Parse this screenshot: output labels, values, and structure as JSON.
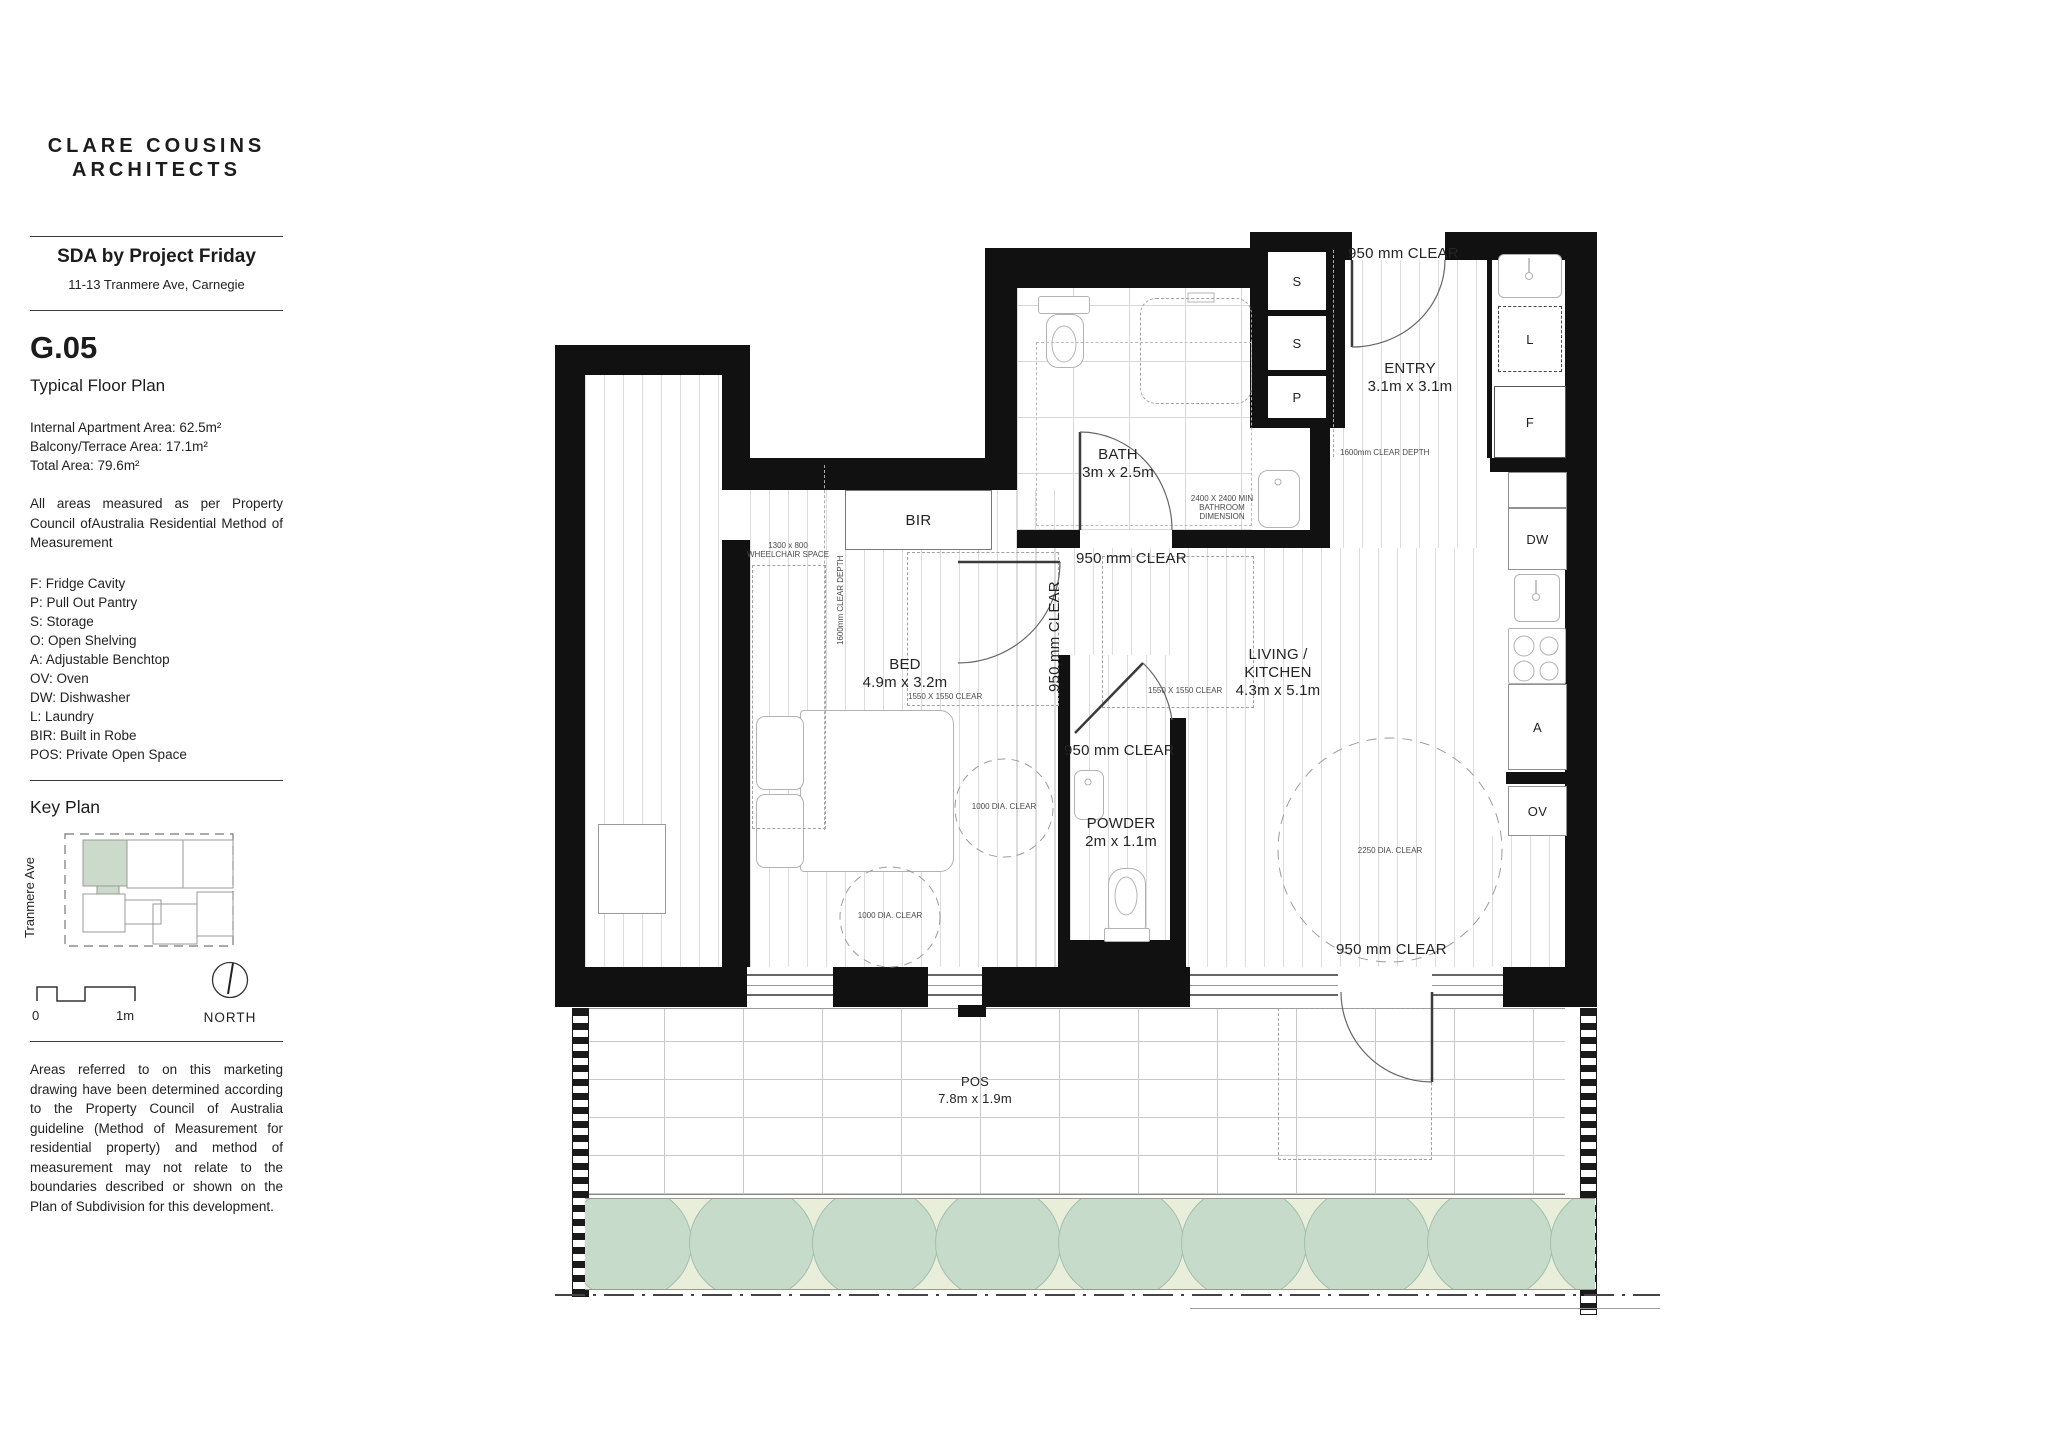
{
  "sidebar": {
    "brand_line1": "CLARE COUSINS",
    "brand_line2": "ARCHITECTS",
    "project_name": "SDA by Project Friday",
    "project_address": "11-13 Tranmere Ave, Carnegie",
    "unit_code": "G.05",
    "plan_type": "Typical Floor Plan",
    "areas": {
      "internal": "Internal Apartment Area: 62.5m²",
      "balcony": "Balcony/Terrace Area: 17.1m²",
      "total": "Total Area: 79.6m²"
    },
    "measurement_note": "All areas measured as per Property Council ofAustralia Residential Method of Measurement",
    "legend": {
      "items": [
        "F: Fridge Cavity",
        "P: Pull Out Pantry",
        "S: Storage",
        "O: Open Shelving",
        "A: Adjustable Benchtop",
        "OV: Oven",
        "DW: Dishwasher",
        "L: Laundry",
        "BIR: Built in Robe",
        "POS: Private Open Space"
      ]
    },
    "key_plan": {
      "heading": "Key Plan",
      "street": "Tranmere Ave"
    },
    "scale": {
      "zero": "0",
      "one": "1m"
    },
    "north_label": "NORTH",
    "disclaimer": "Areas referred to on this marketing drawing have been determined according to the Property Council of Australia guideline (Method of Measurement for residential property) and method of measurement may not relate to the boundaries described or shown on the Plan of Subdivision for this development."
  },
  "plan": {
    "rooms": {
      "bath": {
        "name": "BATH",
        "dims": "3m x 2.5m"
      },
      "entry": {
        "name": "ENTRY",
        "dims": "3.1m x 3.1m"
      },
      "bed": {
        "name": "BED",
        "dims": "4.9m x 3.2m"
      },
      "living": {
        "name_line1": "LIVING /",
        "name_line2": "KITCHEN",
        "dims": "4.3m x 5.1m"
      },
      "powder": {
        "name": "POWDER",
        "dims": "2m x 1.1m"
      },
      "pos": {
        "name": "POS",
        "dims": "7.8m x 1.9m"
      },
      "bir": "BIR"
    },
    "fixtures": {
      "s1": "S",
      "s2": "S",
      "p": "P",
      "l": "L",
      "f": "F",
      "dw": "DW",
      "a": "A",
      "ov": "OV"
    },
    "clearances": {
      "entry": "950 mm CLEAR",
      "hall_top": "950 mm CLEAR",
      "hall_side": "950 mm CLEAR",
      "powder": "950 mm CLEAR",
      "pos": "950 mm CLEAR"
    },
    "annotations": {
      "wheelchair_line1": "1300 x 800",
      "wheelchair_line2": "WHEELCHAIR SPACE",
      "clear_depth_bed": "1600mm CLEAR DEPTH",
      "clear_depth_entry": "1600mm CLEAR DEPTH",
      "bed_square": "1550 X 1550 CLEAR",
      "living_square": "1550 X 1550 CLEAR",
      "bed_circle": "1000 DIA. CLEAR",
      "bed_circle2": "1000 DIA. CLEAR",
      "living_circle": "2250 DIA. CLEAR",
      "bath_min_line1": "2400 X 2400 MIN",
      "bath_min_line2": "BATHROOM",
      "bath_min_line3": "DIMENSION"
    }
  },
  "colors": {
    "wall_black": "#111111",
    "keyplan_highlight_green": "#ccdacb",
    "garden_green": "#e9eedb",
    "tree_green": "#c7dbcb"
  }
}
